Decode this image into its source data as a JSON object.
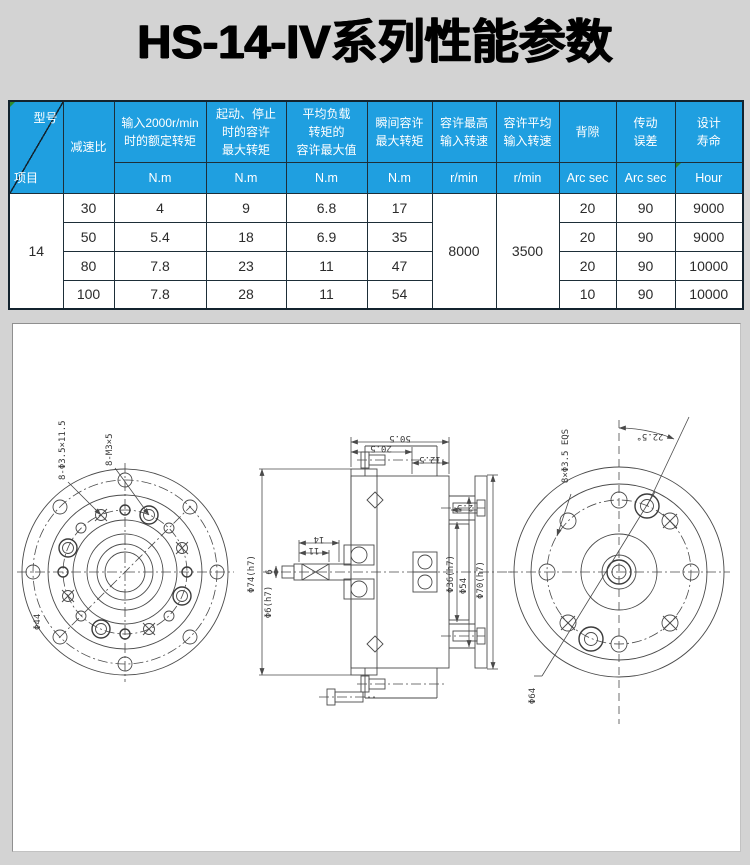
{
  "page": {
    "title": "HS-14-IV系列性能参数"
  },
  "table": {
    "corner": {
      "top_right": "型号",
      "bottom_left": "项目"
    },
    "headers": {
      "ratio": "减速比",
      "rated": "输入2000r/min\n时的额定转矩",
      "start_stop": "起动、停止\n时的容许\n最大转矩",
      "avg_load": "平均负载\n转矩的\n容许最大值",
      "instant": "瞬间容许\n最大转矩",
      "max_speed": "容许最高\n输入转速",
      "avg_speed": "容许平均\n输入转速",
      "backlash": "背隙",
      "error": "传动\n误差",
      "life": "设计\n寿命"
    },
    "units": {
      "rated": "N.m",
      "start_stop": "N.m",
      "avg_load": "N.m",
      "instant": "N.m",
      "max_speed": "r/min",
      "avg_speed": "r/min",
      "backlash": "Arc sec",
      "error": "Arc sec",
      "life": "Hour"
    },
    "model": "14",
    "max_speed_value": "8000",
    "avg_speed_value": "3500",
    "rows": [
      {
        "ratio": "30",
        "rated": "4",
        "start_stop": "9",
        "avg_load": "6.8",
        "instant": "17",
        "backlash": "20",
        "error": "90",
        "life": "9000"
      },
      {
        "ratio": "50",
        "rated": "5.4",
        "start_stop": "18",
        "avg_load": "6.9",
        "instant": "35",
        "backlash": "20",
        "error": "90",
        "life": "9000"
      },
      {
        "ratio": "80",
        "rated": "7.8",
        "start_stop": "23",
        "avg_load": "11",
        "instant": "47",
        "backlash": "20",
        "error": "90",
        "life": "10000"
      },
      {
        "ratio": "100",
        "rated": "7.8",
        "start_stop": "28",
        "avg_load": "11",
        "instant": "54",
        "backlash": "10",
        "error": "90",
        "life": "10000"
      }
    ]
  },
  "drawing": {
    "front_view": {
      "holes_label": "8-Φ3.5×11.5",
      "thread_label": "8-M3×5",
      "dia_label": "Φ44"
    },
    "section_view": {
      "dim_total": "50.5",
      "dim_inner": "20.5",
      "dim_right": "12.5",
      "dim_offset": "2.5",
      "dim_hub": "14",
      "dim_key": "11",
      "dim_shaft": "6",
      "dia_flange": "Φ74(h7)",
      "dia_shaft": "Φ6(h7)",
      "dia_bearing": "Φ36(h7)",
      "dia_mid": "Φ54",
      "dia_outer": "Φ70(h7)"
    },
    "rear_view": {
      "holes_label": "8×Φ3.5 EQS",
      "angle_label": "22.5°",
      "dia_label": "Φ64"
    }
  }
}
